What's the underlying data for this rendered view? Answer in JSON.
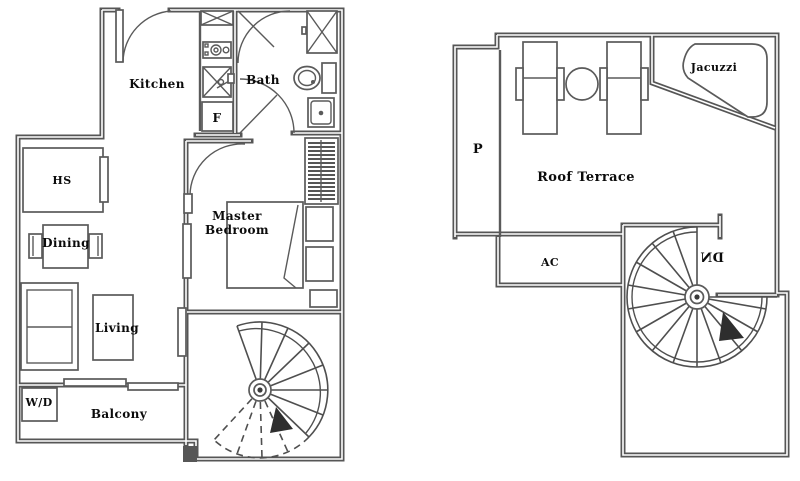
{
  "palette": {
    "background": "#ffffff",
    "wall_line": "#565656",
    "wall_core": "#ffffff",
    "fixture_line": "#5a5a5a",
    "label_text": "#0b0b0b"
  },
  "plans": {
    "unit": {
      "name": "lower-unit-floor-plan",
      "labels": {
        "kitchen": "Kitchen",
        "bath": "Bath",
        "fridge": "F",
        "hs": "HS",
        "dining": "Dining",
        "living": "Living",
        "washer_dryer": "W/D",
        "balcony": "Balcony",
        "master_bedroom_line1": "Master",
        "master_bedroom_line2": "Bedroom"
      }
    },
    "roof": {
      "name": "roof-terrace-floor-plan",
      "labels": {
        "planter": "P",
        "roof_terrace": "Roof Terrace",
        "jacuzzi": "Jacuzzi",
        "ac": "AC",
        "stair_down": "DN"
      }
    }
  }
}
